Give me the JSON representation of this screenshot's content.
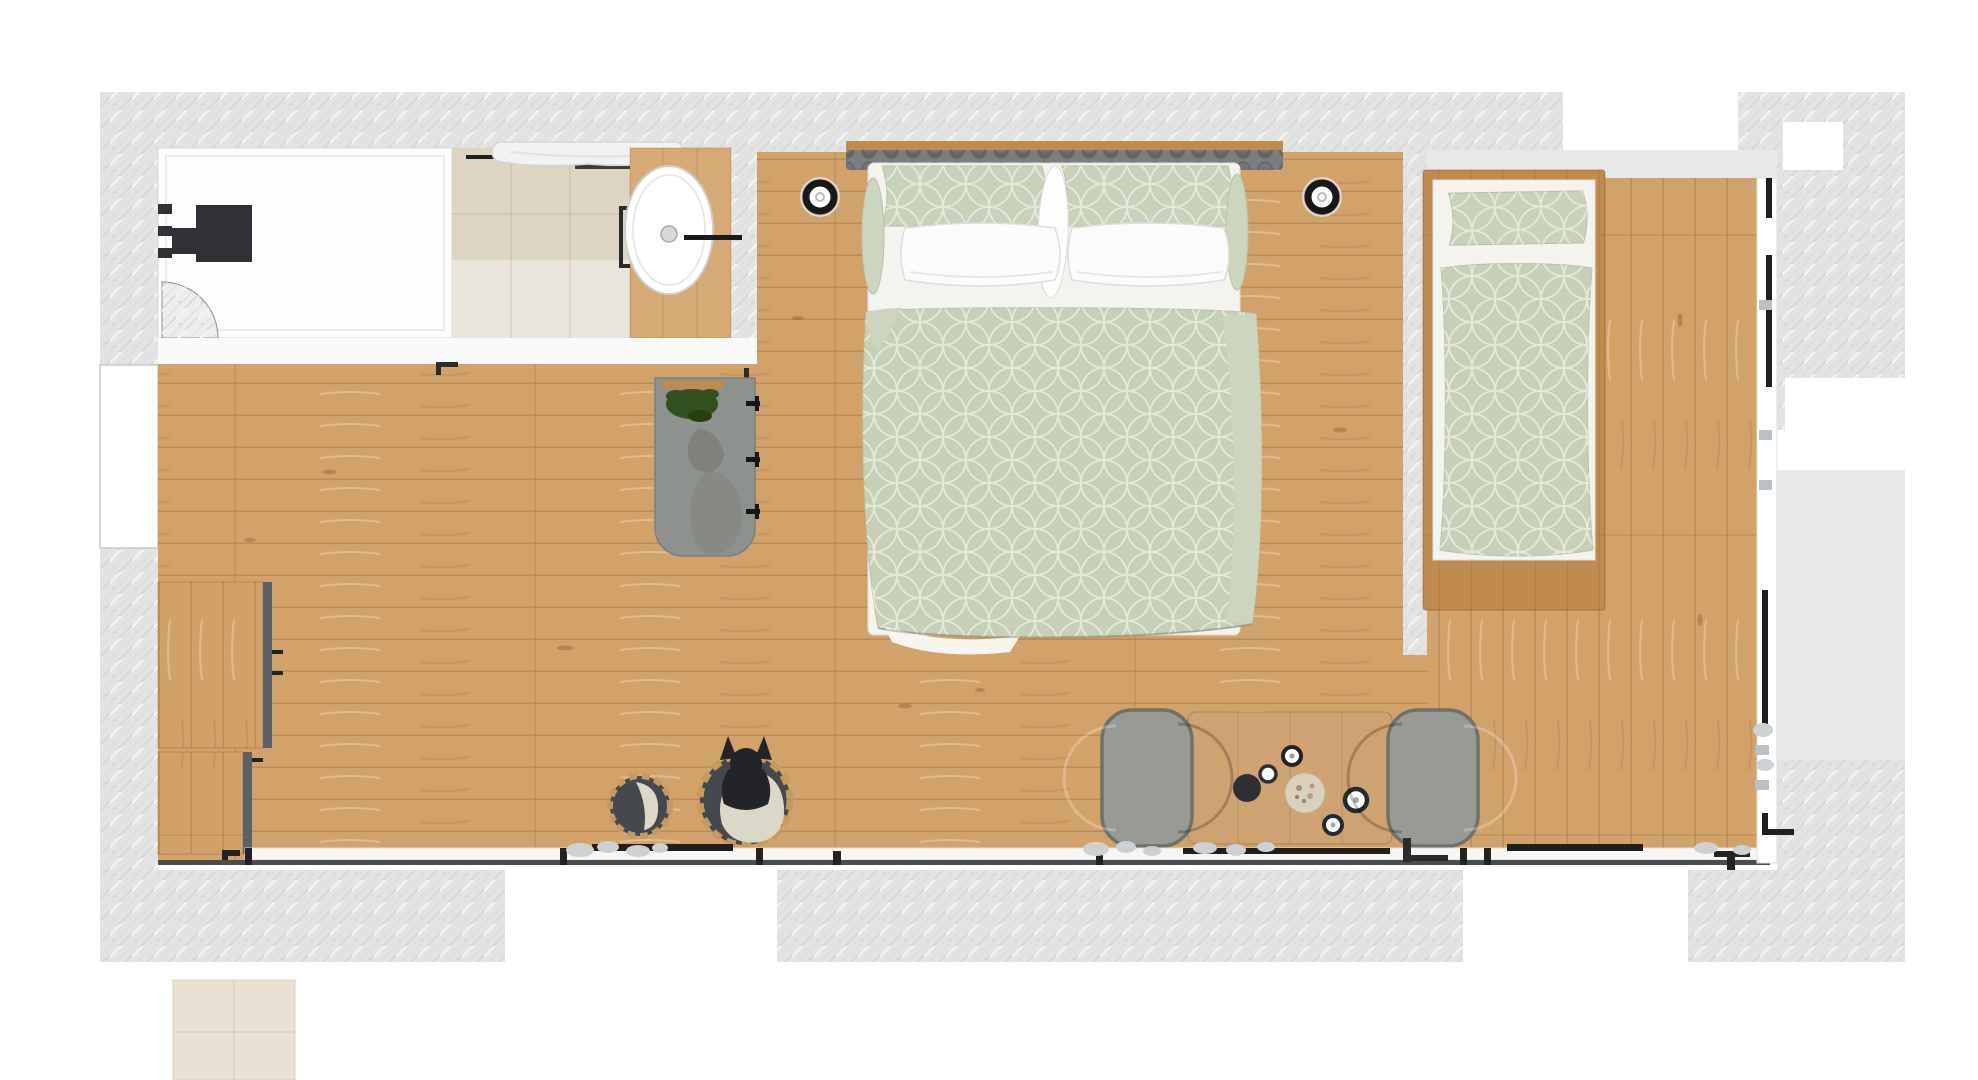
{
  "scene": "hotel-room-floor-plan",
  "palette": {
    "pageBg": "#ffffff",
    "hatch": "#e3e3e3",
    "smoothGray": "#e8e8e8",
    "bathFloor": "#fdfdfd",
    "wallBand": "#fafafa",
    "tileBeige": "#ddd4c2",
    "tileLight": "#e9e2d3",
    "floorWood": "#d2a26b",
    "frameWood": "#c08b4f",
    "vanityWood": "#d7a975",
    "tableWood": "#cfa371",
    "cabinetWood": "#d0a26a",
    "cabinetEdge": "#5d6064",
    "darkFixture": "#2f3134",
    "shelfDark": "#3a3c3e",
    "headboard": "#7a7d82",
    "sage": "#c6cfb7",
    "sageLight": "#cdd5bf",
    "sagePillow": "#c8d1ba",
    "mattressWhite": "#f4f3ee",
    "pillowWhite": "#fbfbfb",
    "grayMat": "#8e928f",
    "stoneGray": "#858883",
    "plantGreen": "#31511f",
    "chair": "#979b93",
    "chairEdge": "#6e726b",
    "dog": "#22242a",
    "basketRing": "#c59a62",
    "basketInside": "#45484c",
    "blanket": "#dbd8c8",
    "sill": "#f6f6f6",
    "lineDark": "#4c4c4c",
    "glyphBlack": "#1f1f1f",
    "pebble": "#ccd1d4",
    "sinkWhite": "#ffffff",
    "drainGray": "#d8d8d8"
  },
  "labels": {
    "floor_plan": "Floor plan of studio hotel room",
    "exterior_walls": "Exterior walls (hatched)",
    "terrace": "Terrace / exterior surfaces",
    "bathroom": "Bathroom",
    "shower": "Walk-in shower with towel",
    "shower_fixture": "Shower fixture",
    "vanity": "Vanity with washbasin",
    "washbasin": "Washbasin",
    "door_swing": "Bathroom door swing",
    "main_room": "Main room wood floor",
    "kitchenette": "Kitchenette cabinets",
    "plant_stand": "Gray mat with plant and hooks",
    "wall_light_left": "Wall light",
    "wall_light_right": "Wall light",
    "double_bed": "Double bed with patterned duvet",
    "single_bed": "Single bed with patterned duvet",
    "single_room": "Second sleeping area",
    "dining_set": "Table for two with armchairs",
    "dog_bed": "Dog sitting in round pet bed",
    "small_basket": "Small storage basket",
    "bottom_windows": "Window front with sliding doors",
    "right_windows": "Right-side window front",
    "outside_tile": "Exterior tile patch"
  }
}
